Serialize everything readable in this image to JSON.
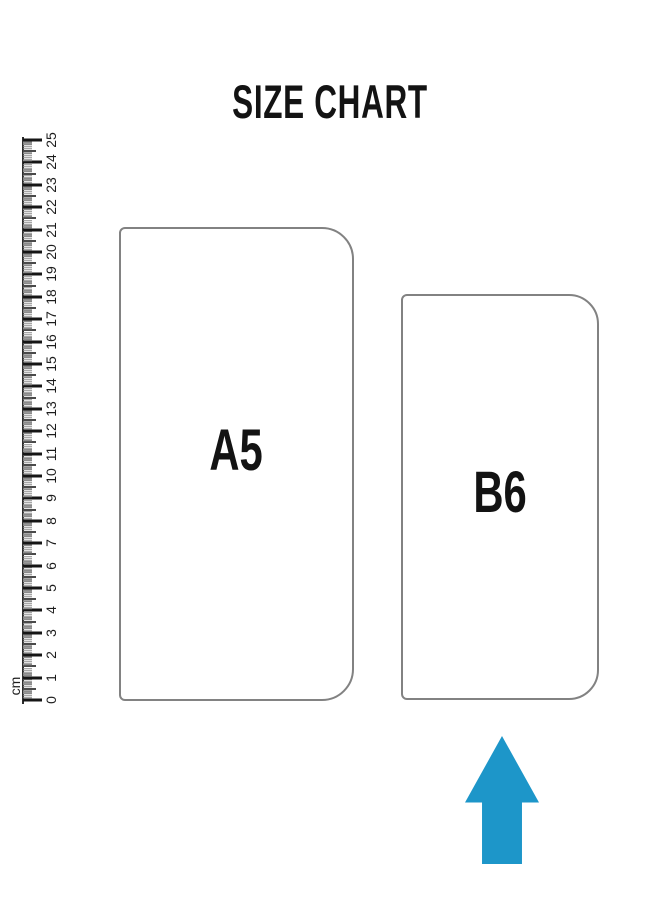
{
  "title": "SIZE CHART",
  "colors": {
    "outline_gray": "#828282",
    "arrow_blue": "#1d96c9",
    "text_black": "#131313"
  },
  "ruler": {
    "unit_label": "cm",
    "numbers": [
      0,
      1,
      2,
      3,
      4,
      5,
      6,
      7,
      8,
      9,
      10,
      11,
      12,
      13,
      14,
      15,
      16,
      17,
      18,
      19,
      20,
      21,
      22,
      23,
      24,
      25
    ]
  },
  "sizes": [
    {
      "label": "A5"
    },
    {
      "label": "B6",
      "highlighted_by_arrow": true
    }
  ],
  "arrow": {
    "direction": "up",
    "color": "#1d96c9"
  }
}
